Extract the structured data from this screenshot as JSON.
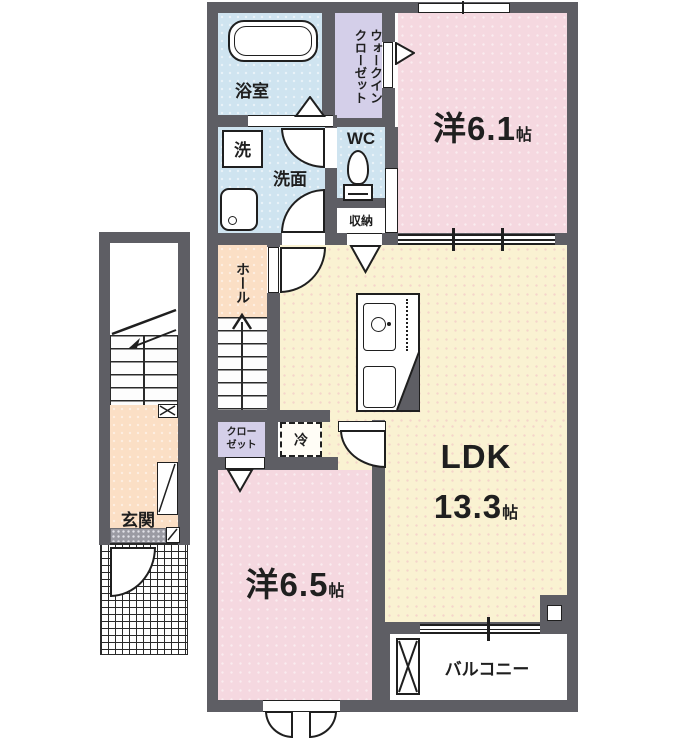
{
  "figure": {
    "type": "apartment-floor-plan"
  },
  "rooms": {
    "bath": {
      "label": "浴室"
    },
    "walk_in_closet": {
      "line1": "ウォークイン",
      "line2": "クローゼット"
    },
    "western_6_1": {
      "name": "洋6.1",
      "unit": "帖"
    },
    "washer": {
      "label": "洗"
    },
    "washroom": {
      "label": "洗面"
    },
    "wc": {
      "label": "WC"
    },
    "storage": {
      "label": "収納"
    },
    "hall": {
      "label": "ホール"
    },
    "closet": {
      "line1": "クロー",
      "line2": "ゼット"
    },
    "fridge": {
      "label": "冷"
    },
    "ldk": {
      "name": "LDK",
      "size": "13.3",
      "unit": "帖"
    },
    "western_6_5": {
      "name": "洋6.5",
      "unit": "帖"
    },
    "balcony": {
      "label": "バルコニー"
    },
    "entrance": {
      "label": "玄関"
    }
  },
  "colors": {
    "wall": "#5e5e64",
    "room_pink": "#f5d8e0",
    "room_cream": "#faf2d2",
    "room_blue": "#cfe4f0",
    "room_lavender": "#d4cfe9",
    "room_peach": "#fbdfc5",
    "outline": "#1f1f1f"
  }
}
